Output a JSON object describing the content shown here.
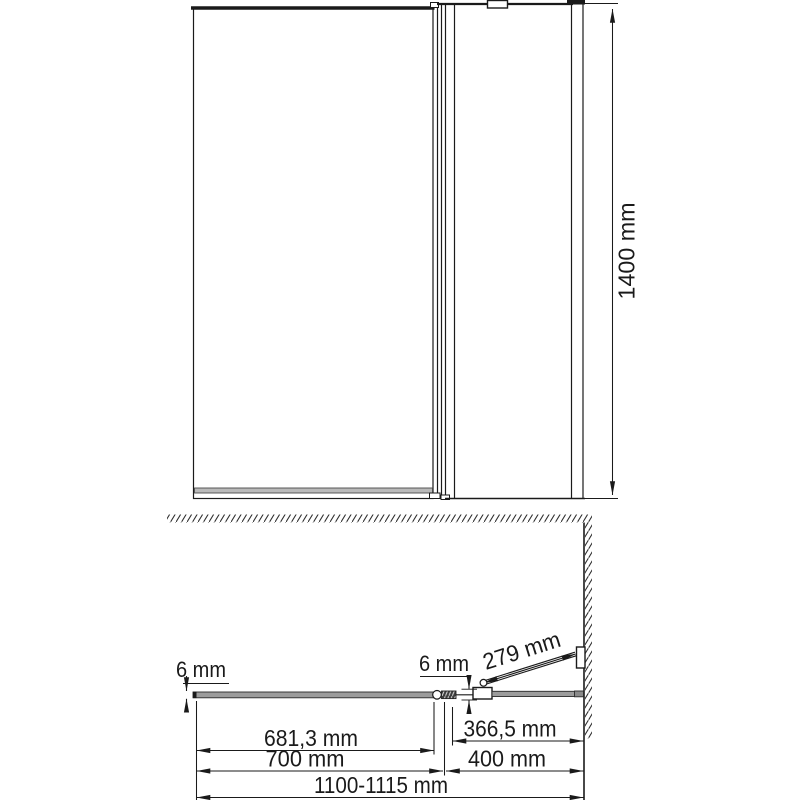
{
  "front_view": {
    "height_label": "1400 mm"
  },
  "plan_view": {
    "fixed_glass_thickness_label": "6 mm",
    "door_glass_thickness_label": "6 mm",
    "arm_length_label": "279 mm",
    "fixed_glass_width_label": "681,3 mm",
    "door_glass_width_label": "366,5 mm",
    "fixed_section_width_label": "700 mm",
    "door_section_width_label": "400 mm",
    "total_width_label": "1100-1115 mm"
  },
  "colors": {
    "line": "#1a1a1a",
    "glass_gray": "#9c9c9c",
    "background": "#ffffff"
  }
}
